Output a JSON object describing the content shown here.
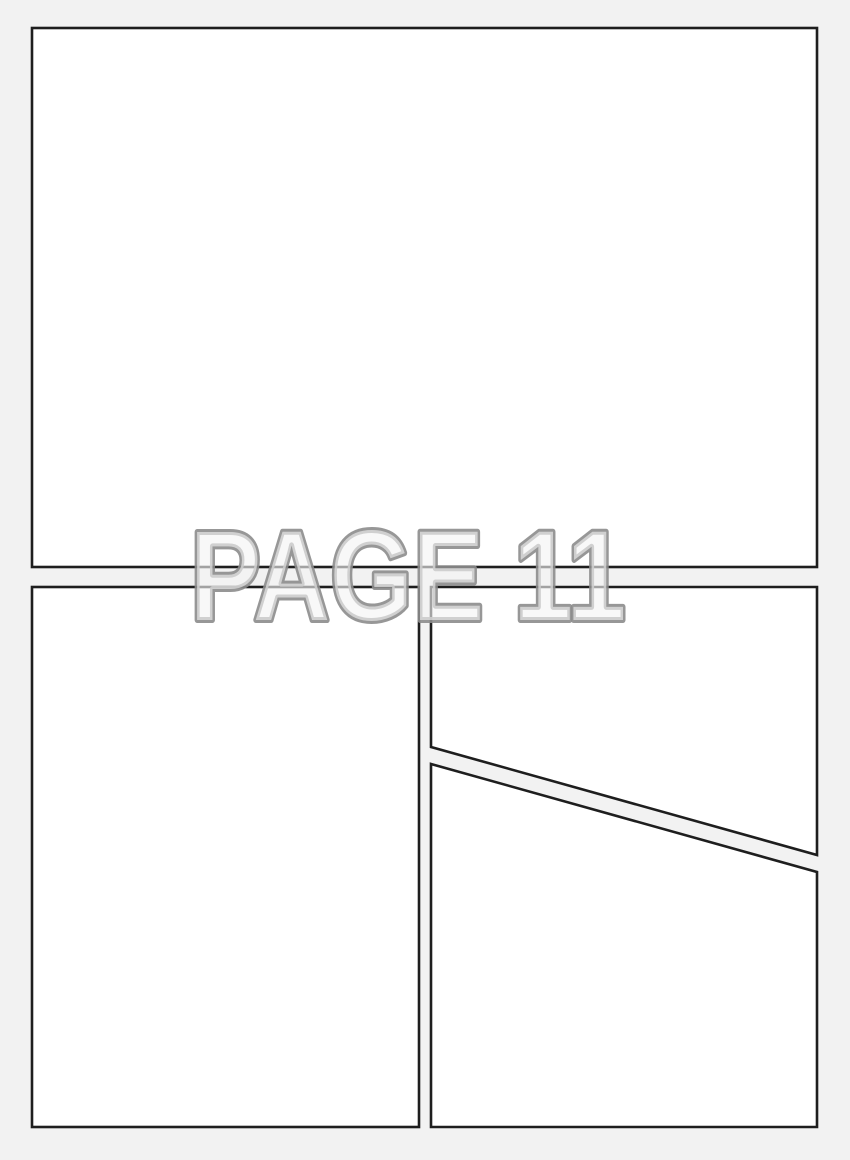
{
  "page": {
    "label": "PAGE 11",
    "panel_count": 4
  },
  "colors": {
    "background": "#f2f2f2",
    "panel_fill": "#ffffff",
    "panel_border": "#1e1e1e",
    "label_fill": "#f3f3f3",
    "label_fill_opacity": "0.62",
    "label_outline": "#8c8c8c",
    "label_outline_opacity": "0.9"
  }
}
